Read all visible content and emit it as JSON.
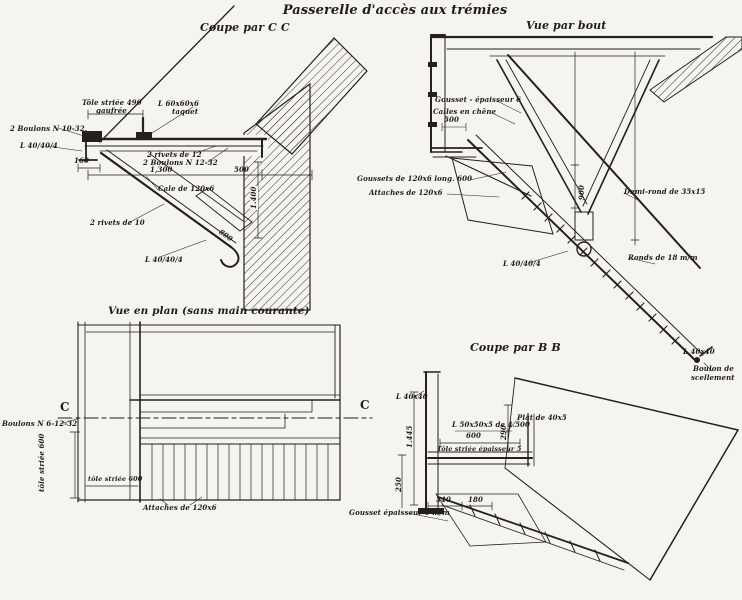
{
  "colors": {
    "paper": "#f5f4ef",
    "ink": "#24211d"
  },
  "title": "Passerelle d'accès aux trémies",
  "views": {
    "coupe_cc": {
      "title": "Coupe par C C",
      "labels": {
        "tole_striee": "Tôle striée 490",
        "tole_striee_2": "gaufrée",
        "boulons_10": "2 Boulons N 10-32",
        "corniere_gauche": "L 40/40/4",
        "dim_160": "160",
        "corniere_60": "L 60x60x6",
        "taquet": "taquet",
        "rivets_12": "2 rivets de 12",
        "boulons_12": "2 Boulons N 12-32",
        "dim_1300": "1,300",
        "dim_500": "500",
        "cale": "Cale de 120x6",
        "rivets_10": "2 rivets de 10",
        "corniere_bas": "L 40/40/4",
        "dim_1400": "1.400",
        "dim_800": "800"
      }
    },
    "vue_bout": {
      "title": "Vue par bout",
      "labels": {
        "gousset_ep": "Gousset - épaisseur 6",
        "calles_chene": "Calles en chêne",
        "dim_500": "500",
        "goussets_long": "Goussets de 120x6 long. 600",
        "attaches": "Attaches de 120x6",
        "demi_rond": "Demi-rond de 35x15",
        "dim_900": "900",
        "ronds_18": "Ronds de 18 m/m",
        "corniere": "L 40/40/4",
        "corniere_fin": "L 40x40",
        "boulon_scellement_1": "Boulon de",
        "boulon_scellement_2": "scellement"
      }
    },
    "vue_plan": {
      "title": "Vue en plan (sans main courante)",
      "labels": {
        "repere_c_gauche": "C",
        "repere_c_droit": "C",
        "boulons": "Boulons N 6-12-32",
        "tole_striee_vert": "tôle striée 600",
        "tole_striee_h": "tôle striée 600",
        "attaches": "Attaches de 120x6"
      }
    },
    "coupe_bb": {
      "title": "Coupe par B B",
      "labels": {
        "corniere_haut": "L 40x40",
        "dim_1445": "1.445",
        "dim_250": "250",
        "corniere_1500": "L 50x50x5 de 4.500",
        "dim_600": "600",
        "tole_ep": "Tôle striée épaisseur 5",
        "plat": "Plat de 40x5",
        "dim_290": "290",
        "gousset": "Gousset épaisseur 6 m/m",
        "dim_340": "340",
        "dim_180": "180"
      }
    }
  }
}
